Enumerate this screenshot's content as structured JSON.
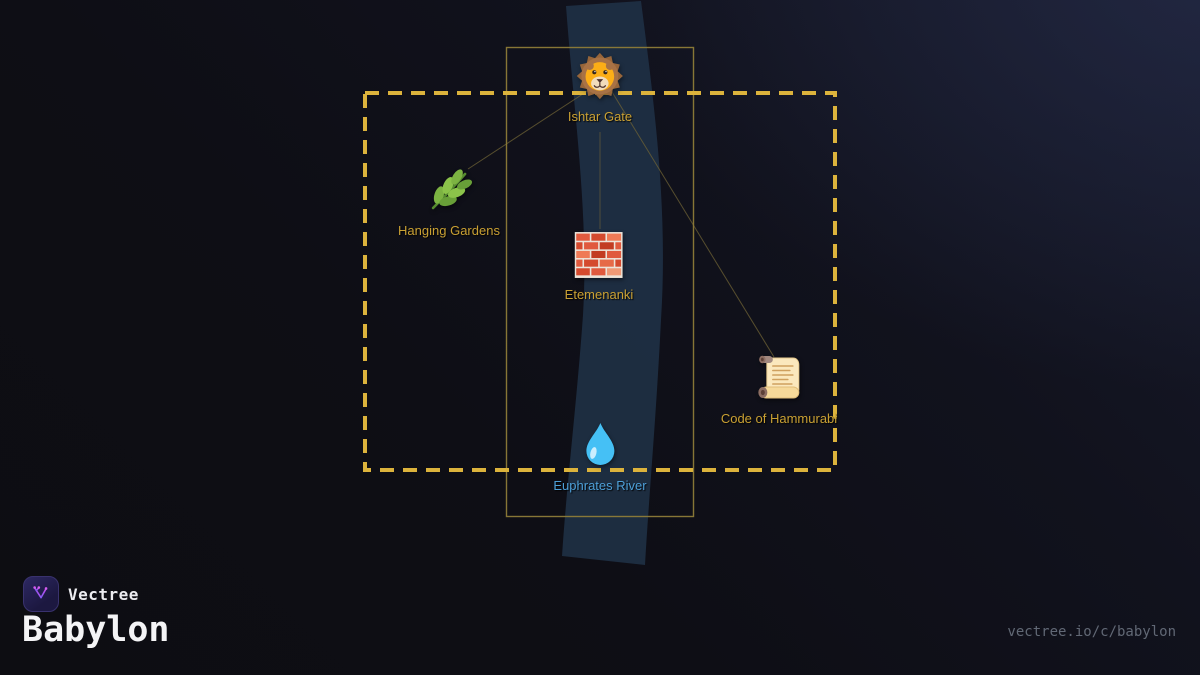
{
  "brand": {
    "name": "Vectree"
  },
  "footer": {
    "collection_title": "Babylon",
    "share_url": "vectree.io/c/babylon"
  },
  "map": {
    "nodes": [
      {
        "id": "ishtar-gate",
        "label": "Ishtar Gate",
        "icon": "lion-emoji-icon",
        "x": 600,
        "y": 76,
        "label_style": "gold"
      },
      {
        "id": "hanging-gardens",
        "label": "Hanging Gardens",
        "icon": "herb-emoji-icon",
        "x": 449,
        "y": 190,
        "label_style": "gold"
      },
      {
        "id": "etemenanki",
        "label": "Etemenanki",
        "icon": "brick-emoji-icon",
        "x": 599,
        "y": 256,
        "label_style": "gold"
      },
      {
        "id": "code-of-hammurabi",
        "label": "Code of Hammurabi",
        "icon": "scroll-emoji-icon",
        "x": 779,
        "y": 378,
        "label_style": "gold"
      },
      {
        "id": "euphrates-river",
        "label": "Euphrates River",
        "icon": "droplet-emoji-icon",
        "x": 600,
        "y": 445,
        "label_style": "water"
      }
    ],
    "edges": [
      {
        "from": "ishtar-gate",
        "to": "hanging-gardens"
      },
      {
        "from": "ishtar-gate",
        "to": "etemenanki"
      },
      {
        "from": "ishtar-gate",
        "to": "code-of-hammurabi"
      }
    ]
  },
  "colors": {
    "gold_label": "#c9a033",
    "water_label": "#4d9fd8",
    "dashed_border": "#dcb33c",
    "solid_border": "#8e7c38",
    "edge_line": "#6f6336",
    "river_fill": "#1e3044",
    "brand_text": "#ececf0",
    "title_text": "#f4f4f6",
    "url_text": "#616875",
    "badge_accent": "#9f5cf0"
  }
}
